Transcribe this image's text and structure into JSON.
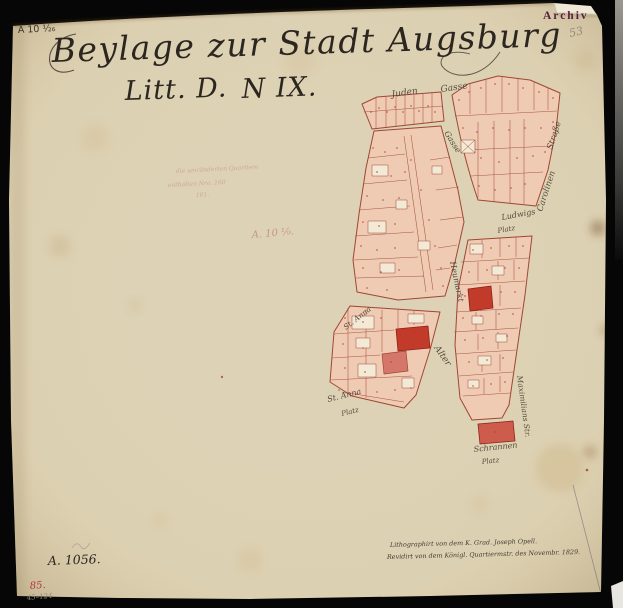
{
  "colors": {
    "paper": "#ddd2b5",
    "parcel_fill": "#f0cbb4",
    "parcel_line": "#9e4734",
    "highlight_parcel": "#c23a2a",
    "ink": "#2c2620",
    "archiv_stamp_color": "#55203f",
    "number_red": "#a84432"
  },
  "header": {
    "corner_mark": "A 10 ¹⁄₂₆",
    "archiv_stamp": "Archiv",
    "pencil_folio": "53",
    "title_line1": "Beylage zur Stadt Augsburg",
    "title_line2a": "Litt. D.",
    "title_line2b": "N IX."
  },
  "annotations": {
    "faint_red_note_line1": "die umränderten Quartiere",
    "faint_red_note_line2": "enthalten Nro. 160",
    "faint_red_note_line3": "161.",
    "faint_red_mark": "A. 10 ¹⁄₉.",
    "bottom_ink_mark": "A. 1056.",
    "bottom_red_mark": "85.",
    "bottom_pencil_mark": "45–124",
    "imprint_line1": "Lithographirt von dem K. Grad. Joseph Opell.",
    "imprint_line2": "Revidirt von dem Königl. Quartiermstr. des Novembr. 1829."
  },
  "map": {
    "labels": {
      "juden": "Juden",
      "gasse_top": "Gasse",
      "gasse_mid": "Gasse",
      "carolinen": "Carolinen",
      "strasse": "Straße",
      "ludwigs": "Ludwigs",
      "ludwigs_platz": "Platz",
      "heumarkt": "Heumarkt",
      "st_anna_gasse": "St. Anna",
      "alter": "Alter",
      "maximilians": "Maximilians Str.",
      "schrannen": "Schrannen",
      "schrannen_platz": "Platz",
      "st_anna_platz_1": "St. Anna",
      "st_anna_platz_2": "Platz"
    }
  }
}
